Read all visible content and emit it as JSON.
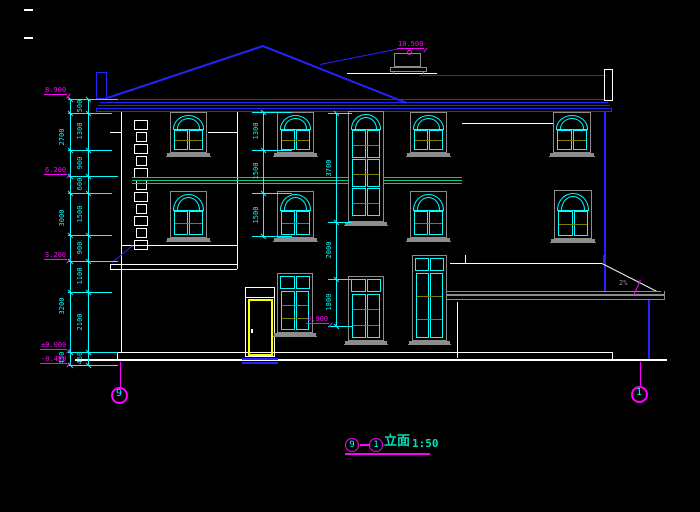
{
  "drawing": {
    "title": {
      "axis_from": "9",
      "separator": "—",
      "axis_to": "1",
      "label": "立面",
      "scale": "1:50"
    },
    "axis_bubbles": {
      "left": "9",
      "right": "1"
    },
    "levels": {
      "chimney_top": "10.500",
      "eave": "8.900",
      "second_floor": "6.200",
      "first_floor": "3.200",
      "ground": "±0.000",
      "base": "-0.450",
      "door_head": "0.900"
    },
    "dims": {
      "outer": [
        "2700",
        "3000",
        "3200",
        "450"
      ],
      "inner": [
        "500",
        "1300",
        "900",
        "600",
        "1500",
        "900",
        "1100",
        "2100",
        "450"
      ],
      "window_left": [
        "1300",
        "1500",
        "1500"
      ],
      "window_center": [
        "3700",
        "2000",
        "1800"
      ]
    },
    "notes": {
      "slope": "2%"
    }
  },
  "colors": {
    "background": "#000000",
    "cyan": "#00ffff",
    "magenta": "#ff00ff",
    "blue": "#2424ff",
    "white": "#ffffff",
    "gray": "#8c8c8c",
    "olive": "#808000",
    "yellow": "#ffff00",
    "teal_green": "#00cc88",
    "title_teal": "#00e0b8"
  }
}
